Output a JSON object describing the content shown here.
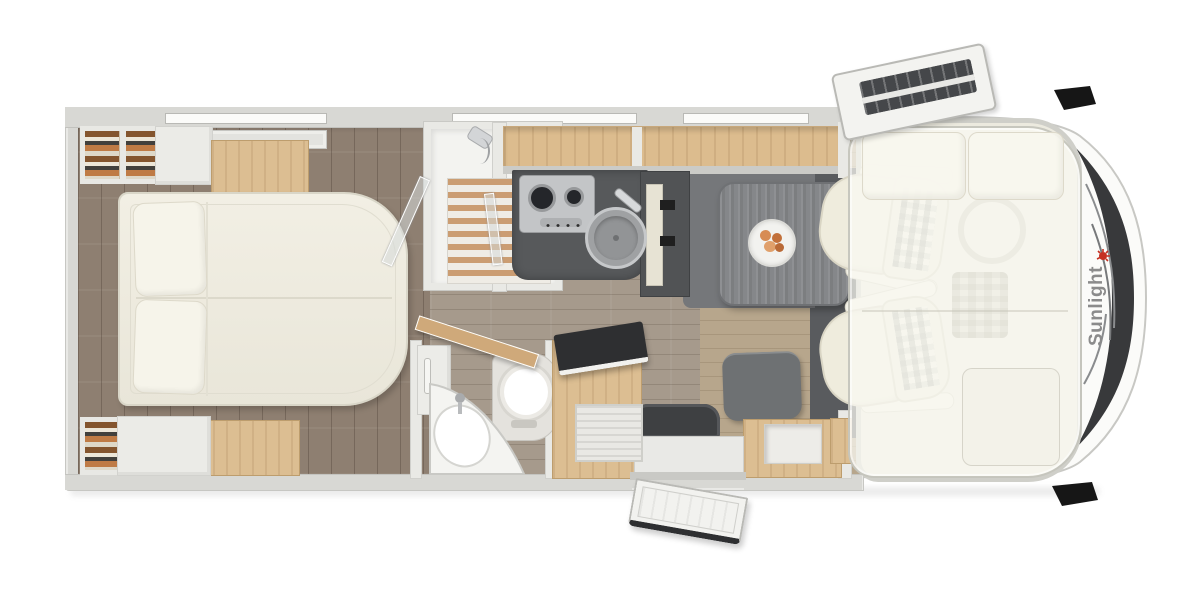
{
  "image_type": "motorhome-floorplan-top-view",
  "brand": {
    "logo_text": "Sunlight",
    "logo_text_color": "#8b8b8b",
    "logo_icon": "sun-icon",
    "logo_icon_color": "#c53022"
  },
  "palette": {
    "background": "#ffffff",
    "body_wall": "#d8d8d4",
    "bedroom_floor": "#8e7f71",
    "corridor_floor": "#a69a8c",
    "dinette_floor": "#b7a68c",
    "furniture_wood": "#dcbc8e",
    "counter_dark": "#57595b",
    "table_gray": "#85878a",
    "upholstery_cream": "#efecdd",
    "windshield_dark": "#38393b"
  },
  "zones": [
    {
      "name": "rear-bedroom",
      "features": [
        "island-bed",
        "two-pillows",
        "wardrobe-top",
        "wardrobe-bottom",
        "overhead-cabinet",
        "skylight"
      ]
    },
    {
      "name": "shower-room",
      "features": [
        "wood-slat-floor",
        "folding-glass-door",
        "shower-head"
      ]
    },
    {
      "name": "kitchen",
      "features": [
        "three-burner-hob",
        "round-sink-with-lid",
        "fridge-tower",
        "overhead-lockers"
      ]
    },
    {
      "name": "bathroom",
      "features": [
        "corner-washbasin",
        "toilet",
        "open-wood-door",
        "vanity-cabinet"
      ]
    },
    {
      "name": "tv-cabinet",
      "features": [
        "flip-up-tv-lid",
        "tambour-roller-door"
      ]
    },
    {
      "name": "dinette",
      "features": [
        "gray-table",
        "plate-of-food",
        "stool-bench",
        "sideboard"
      ]
    },
    {
      "name": "entry",
      "features": [
        "open-entry-door",
        "door-mat",
        "entry-step"
      ]
    },
    {
      "name": "cab",
      "features": [
        "two-swivel-seats",
        "drop-down-bed-overlay",
        "two-bed-pillows",
        "windshield-with-wipers",
        "side-mirrors",
        "open-roof-hatch",
        "sunlight-logo"
      ]
    }
  ]
}
